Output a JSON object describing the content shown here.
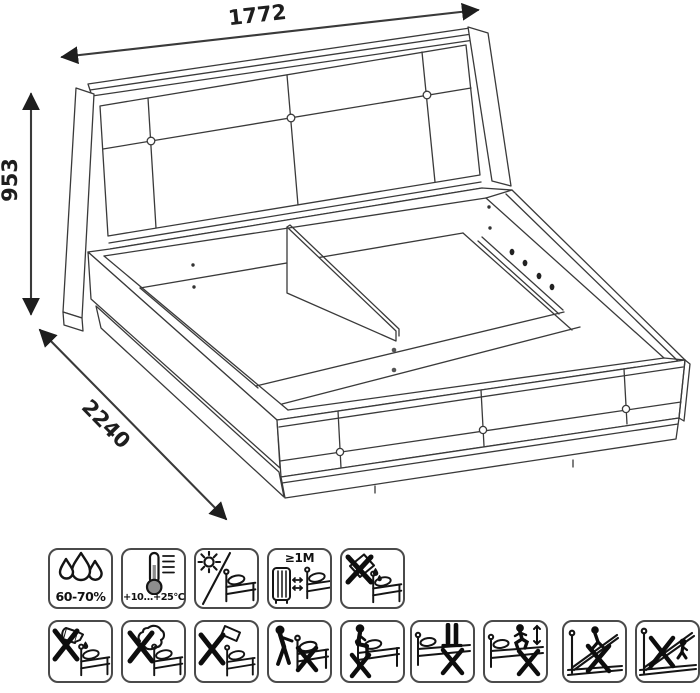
{
  "drawing": {
    "width_mm": "1772",
    "height_mm": "953",
    "length_mm": "2240"
  },
  "care_icons": {
    "row1": [
      {
        "name": "humidity-range-icon",
        "label": "60-70%"
      },
      {
        "name": "temperature-range-icon",
        "label": "+10...+25°C"
      },
      {
        "name": "no-direct-sunlight-icon",
        "label": ""
      },
      {
        "name": "radiator-distance-icon",
        "label": "≥1M"
      },
      {
        "name": "no-spill-liquids-icon",
        "label": ""
      }
    ],
    "row2": [
      {
        "name": "no-pouring-liquids-icon"
      },
      {
        "name": "no-abrasive-objects-icon"
      },
      {
        "name": "no-hammering-icon"
      },
      {
        "name": "no-dragging-bed-icon"
      },
      {
        "name": "no-sitting-on-edge-icon"
      },
      {
        "name": "no-standing-on-bed-icon"
      },
      {
        "name": "no-jumping-on-bed-icon"
      },
      {
        "name": "no-climbing-lifted-frame-icon"
      },
      {
        "name": "no-sitting-on-lifted-frame-icon"
      }
    ]
  },
  "colors": {
    "line": "#3a3a3a",
    "icon_line": "#141414",
    "background": "#ffffff"
  }
}
